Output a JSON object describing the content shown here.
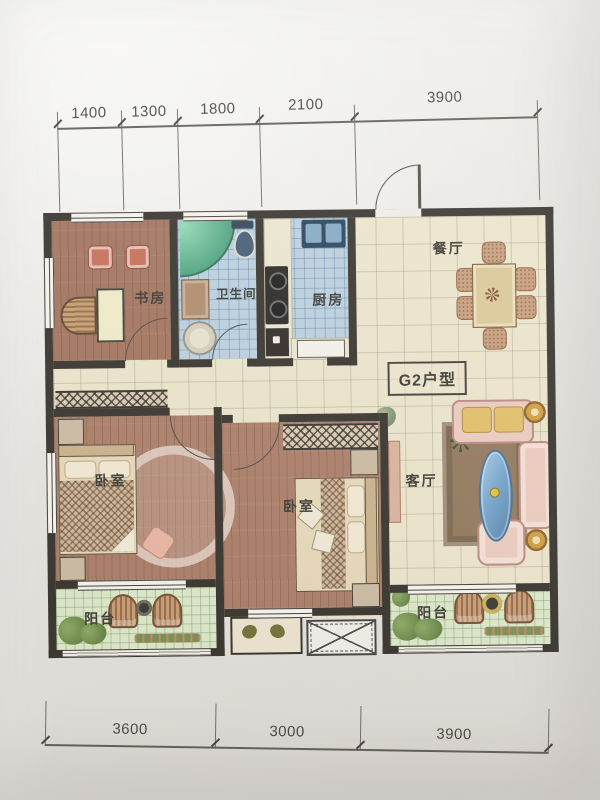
{
  "dimensions": {
    "top": [
      "1400",
      "1300",
      "1800",
      "2100",
      "3900"
    ],
    "bottom": [
      "3600",
      "3000",
      "3900"
    ]
  },
  "rooms": {
    "study": "书房",
    "bathroom": "卫生间",
    "kitchen": "厨房",
    "dining": "餐厅",
    "living": "客厅",
    "bedroom_left": "卧室",
    "bedroom_mid": "卧室",
    "balcony_left": "阳台",
    "balcony_right": "阳台"
  },
  "unit": {
    "label": "G2户型"
  },
  "colors": {
    "wall": "#2e2a24",
    "floor_wood": "#a87962",
    "floor_tile_cream": "#ede5cb",
    "floor_tile_blue": "#b9cfdf",
    "floor_tile_green": "#dde9c9",
    "shower_green": "#4fae85",
    "paper": "#e9e7e3"
  }
}
